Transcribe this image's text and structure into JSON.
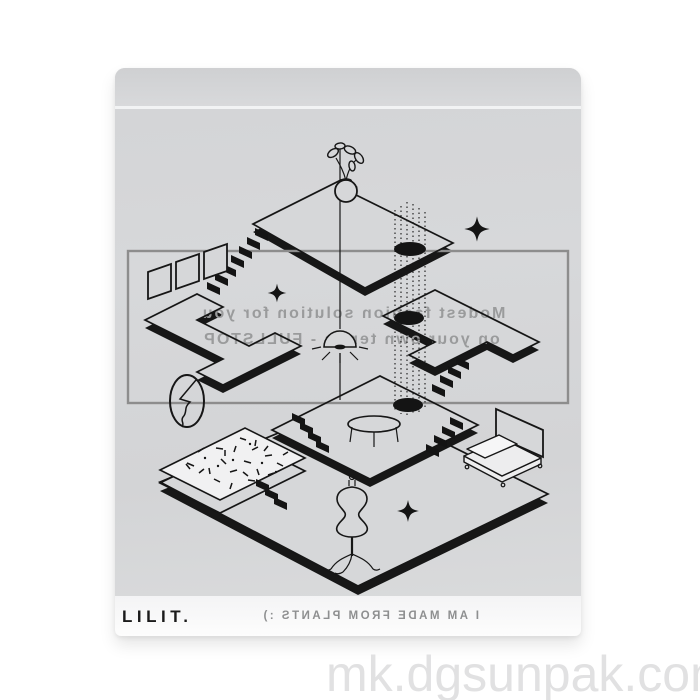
{
  "bag": {
    "color": "#d6d7d9",
    "seal_line_color": "#f2f3f4",
    "bottom_strip_color": "#fdfdfd",
    "brand": "LILIT.",
    "back_print": {
      "color": "#9a9b9c",
      "line1": "Modest fashion solution for you",
      "line2": "on your own terms - FULLSTOP",
      "footer": "I AM MADE FROM PLANTS :)"
    },
    "front_print": {
      "ink_color": "#161616",
      "frame_border_color": "#8d8d8d",
      "elements": [
        "potted-plant",
        "plumb-line",
        "hanging-eye",
        "stepped-platforms",
        "staircases",
        "portal-holes",
        "dotted-threads",
        "picture-frames",
        "lightning-oval",
        "sparkle-stars",
        "round-table",
        "speckled-rug",
        "dress-form-mannequin",
        "bed",
        "screen-panel"
      ]
    }
  },
  "watermark": {
    "text": "mk.dgsunpak.com",
    "color": "#e1e1e2"
  }
}
